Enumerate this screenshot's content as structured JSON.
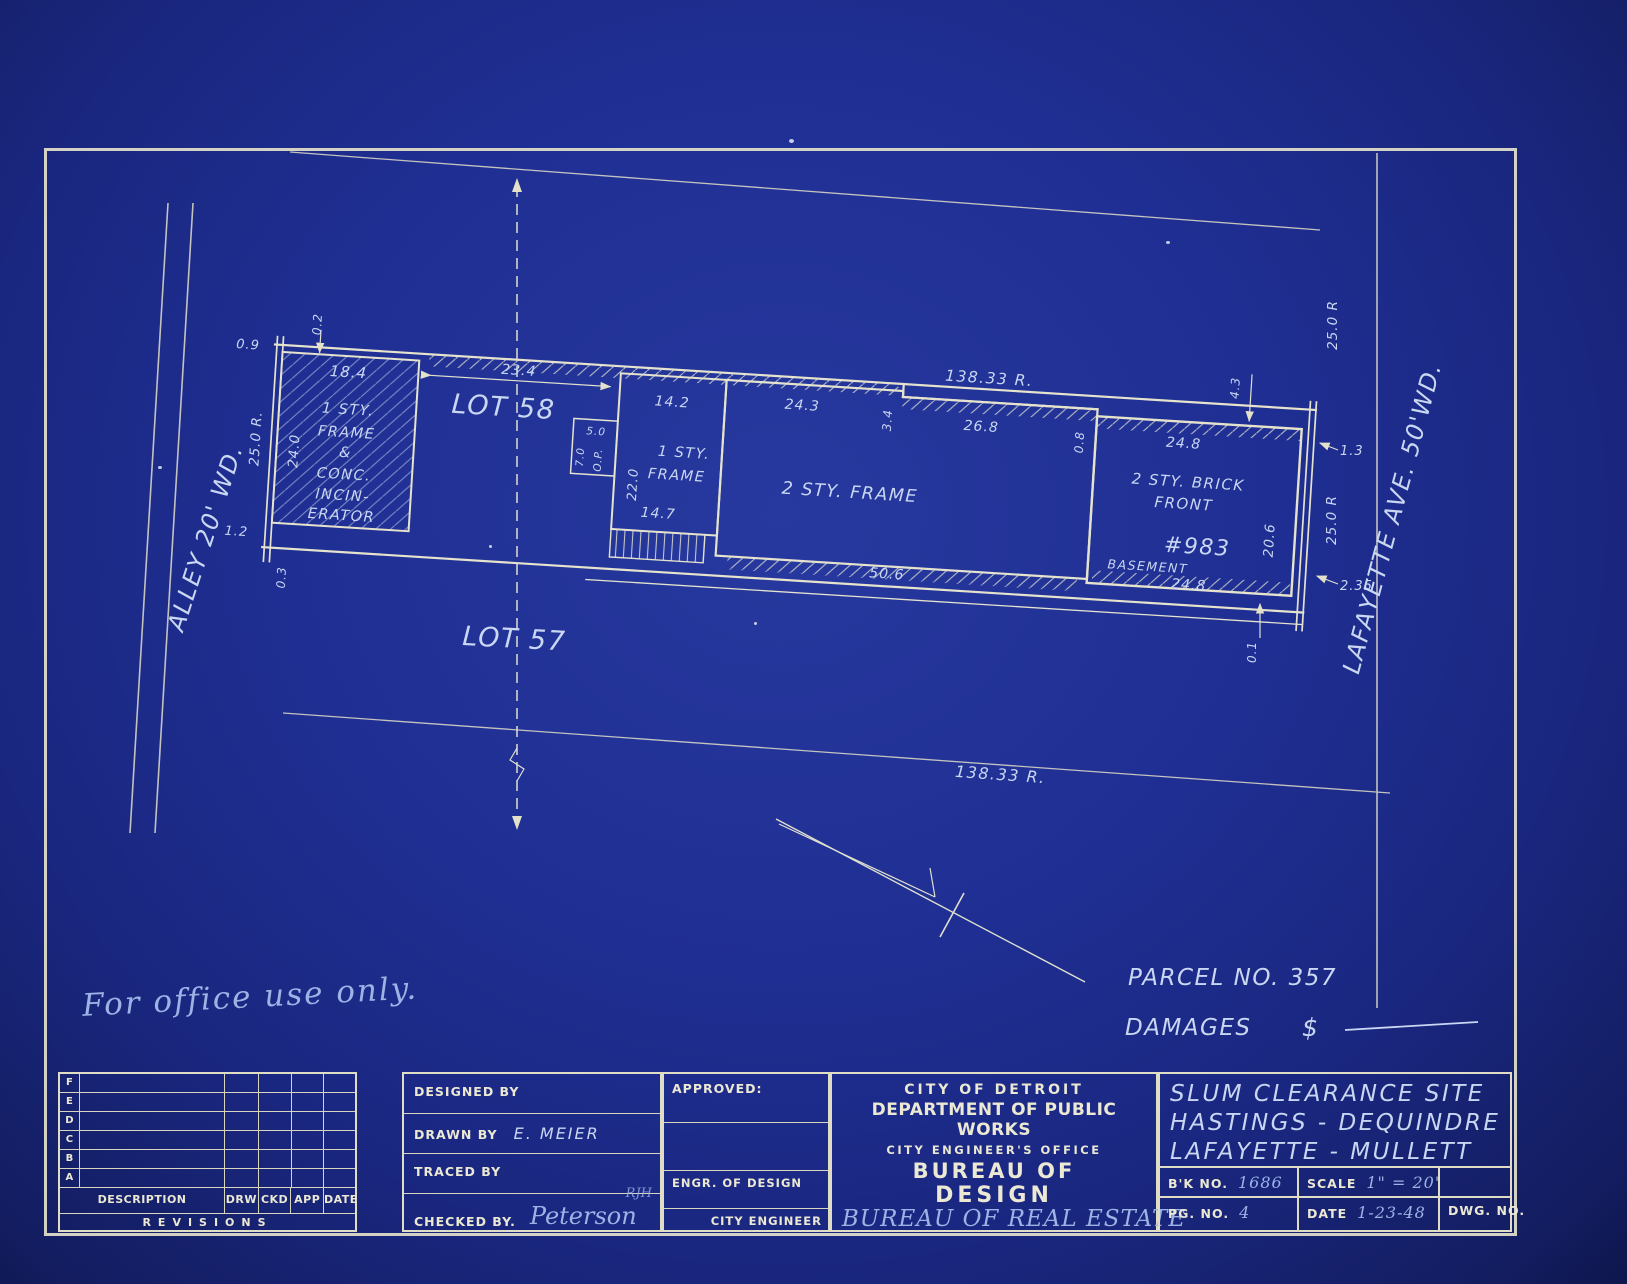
{
  "page": {
    "office_note": "For office use only."
  },
  "parcel": {
    "parcel_no": "PARCEL NO. 357",
    "damages_label": "DAMAGES",
    "dollar": "$"
  },
  "streets": {
    "alley": "ALLEY 20' WD.",
    "lafayette": "LAFAYETTE AVE. 50'WD."
  },
  "lots": {
    "lot58": "LOT 58",
    "lot57": "LOT 57"
  },
  "buildings": {
    "incinerator": {
      "l1": "1 STY.",
      "l2": "FRAME",
      "l3": "&",
      "l4": "CONC.",
      "l5": "INCIN-",
      "l6": "ERATOR"
    },
    "frame1": {
      "l1": "1 STY.",
      "l2": "FRAME"
    },
    "frame2": {
      "label": "2 STY. FRAME"
    },
    "brick": {
      "l1": "2 STY. BRICK",
      "l2": "FRONT",
      "number": "#983",
      "basement": "BASEMENT"
    }
  },
  "dims": {
    "d02": "0.2",
    "d09": "0.9",
    "r25a": "25.0 R.",
    "d240": "24.0",
    "d12": "1.2",
    "d03": "0.3",
    "d184": "18.4",
    "d234": "23.4",
    "d50": "5.0",
    "d70": "7.0",
    "op": "O.P.",
    "d142": "14.2",
    "d220": "22.0",
    "d147": "14.7",
    "d243": "24.3",
    "d34": "3.4",
    "r138a": "138.33 R.",
    "d268": "26.8",
    "d08": "0.8",
    "d43": "4.3",
    "d248a": "24.8",
    "d13": "1.3",
    "r25b": "25.0 R",
    "d206": "20.6",
    "r25c": "25.0 R",
    "d235": "2.35",
    "d506": "50.6",
    "d248b": "24.8",
    "d01": "0.1",
    "r138b": "138.33 R."
  },
  "title_block": {
    "revisions": {
      "letters": [
        "F",
        "E",
        "D",
        "C",
        "B",
        "A"
      ],
      "desc": "DESCRIPTION",
      "drw": "DRW",
      "ckd": "CKD",
      "app": "APP",
      "date": "DATE",
      "footer": "REVISIONS"
    },
    "signatures": {
      "designed": "DESIGNED BY",
      "drawn": "DRAWN BY",
      "drawn_value": "E. MEIER",
      "traced": "TRACED BY",
      "checked": "CHECKED BY.",
      "checked_value": "Peterson",
      "initials": "RJH"
    },
    "approvals": {
      "approved": "APPROVED:",
      "engr": "ENGR. OF DESIGN",
      "city_eng": "CITY ENGINEER"
    },
    "org": {
      "l1": "CITY OF DETROIT",
      "l2": "DEPARTMENT OF PUBLIC WORKS",
      "l3": "CITY ENGINEER'S OFFICE",
      "l4": "BUREAU OF",
      "l5": "DESIGN",
      "l6": "BUREAU OF REAL ESTATE"
    },
    "project": {
      "t1": "SLUM CLEARANCE SITE",
      "t2": "HASTINGS - DEQUINDRE",
      "t3": "LAFAYETTE - MULLETT",
      "bk_label": "B'K NO.",
      "bk": "1686",
      "scale_label": "SCALE",
      "scale": "1\" = 20'",
      "pg_label": "PG. NO.",
      "pg": "4",
      "date_label": "DATE",
      "date": "1-23-48",
      "dwg_label": "DWG. NO."
    }
  }
}
